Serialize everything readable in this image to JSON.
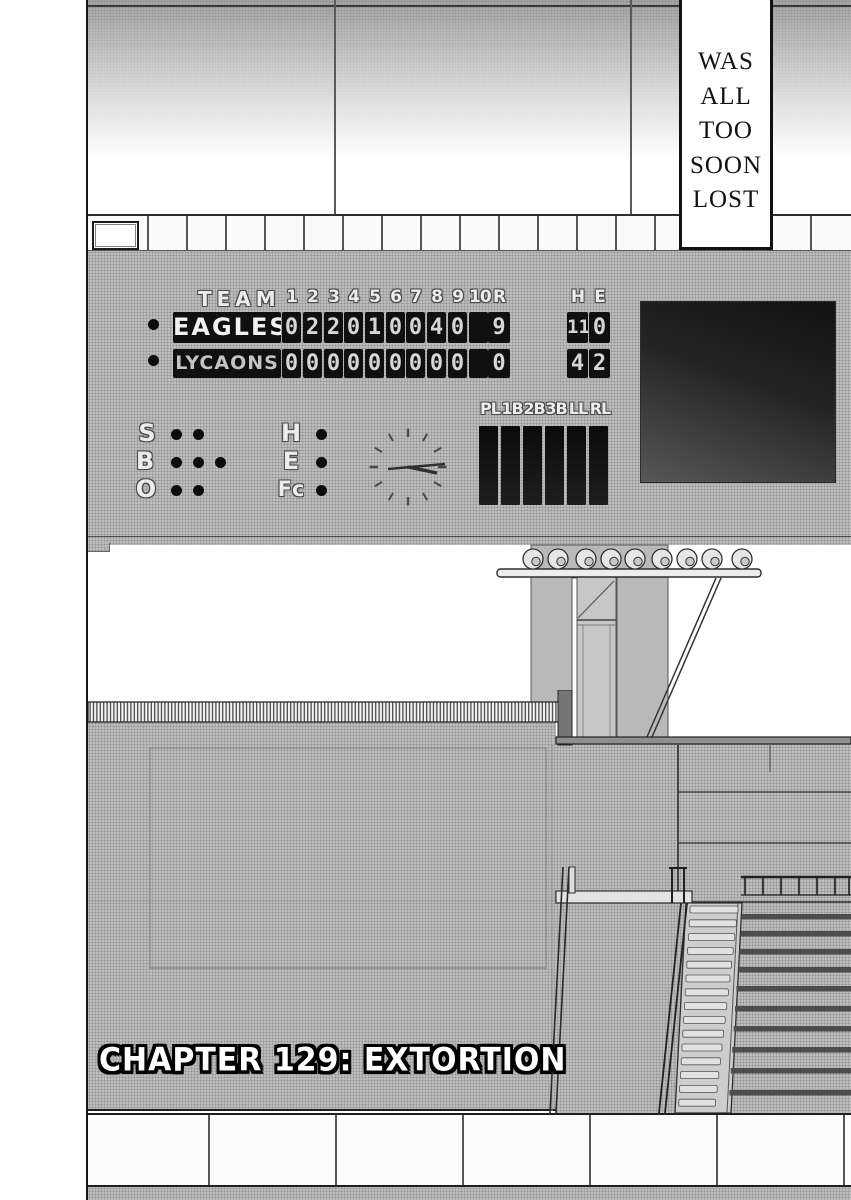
{
  "palette": {
    "ink": "#1a1a1a",
    "halftone_gray": "#bdbdbd",
    "cell_black": "#101010",
    "paper_white": "#ffffff"
  },
  "narration": {
    "text": "WAS ALL TOO SOON LOST"
  },
  "scoreboard": {
    "header": {
      "team": "TEAM",
      "innings": [
        "1",
        "2",
        "3",
        "4",
        "5",
        "6",
        "7",
        "8",
        "9",
        "10"
      ],
      "runs": "R",
      "hits": "H",
      "errors": "E"
    },
    "rows": [
      {
        "name": "EAGLES",
        "innings": [
          "0",
          "2",
          "2",
          "0",
          "1",
          "0",
          "0",
          "4",
          "0",
          ""
        ],
        "runs": "9",
        "hits": "11",
        "errors": "0"
      },
      {
        "name": "LYCAONS",
        "innings": [
          "0",
          "0",
          "0",
          "0",
          "0",
          "0",
          "0",
          "0",
          "0",
          ""
        ],
        "runs": "0",
        "hits": "4",
        "errors": "2"
      }
    ],
    "count_panel": {
      "strike_label": "S",
      "ball_label": "B",
      "out_label": "O",
      "strike_lamps": 2,
      "ball_lamps": 3,
      "out_lamps": 2,
      "hit_label": "H",
      "error_label": "E",
      "fielders_choice_label": "Fc",
      "hit_lamps": 1,
      "error_lamps": 1,
      "fc_lamps": 1
    },
    "umpire_positions": [
      "PL",
      "1B",
      "2B",
      "3B",
      "LL",
      "RL"
    ]
  },
  "chapter": {
    "title": "CHAPTER 129: EXTORTION"
  }
}
